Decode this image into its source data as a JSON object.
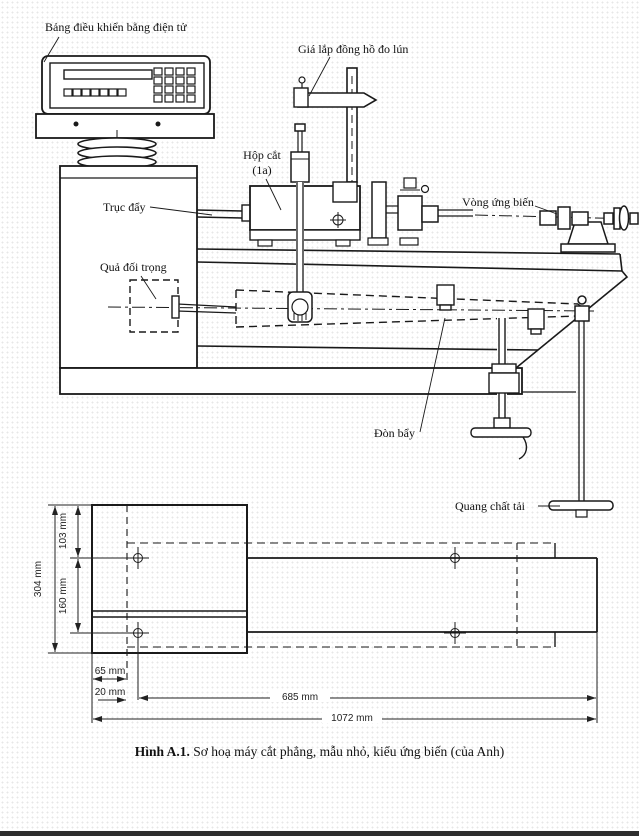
{
  "figure": {
    "caption_label": "Hình A.1.",
    "caption_text": "Sơ hoạ máy cắt phẳng, mẫu nhỏ, kiểu ứng biến (của Anh)"
  },
  "labels": {
    "control_panel": "Bảng điều khiển bằng điện tử",
    "dial_gauge_bracket": "Giá lắp đồng hồ đo lún",
    "shear_box_line1": "Hộp cắt",
    "shear_box_line2": "(1a)",
    "push_shaft": "Trục đẩy",
    "strain_ring": "Vòng ứng biến",
    "counterweight": "Quả đối trọng",
    "lever": "Đòn bẩy",
    "load_hanger": "Quang chất tải"
  },
  "dimensions": {
    "d103": "103 mm",
    "d304": "304 mm",
    "d160": "160 mm",
    "d65": "65 mm",
    "d20": "20 mm",
    "d685": "685 mm",
    "d1072": "1072 mm"
  },
  "colors": {
    "ink": "#1a1a1a",
    "paper": "#ffffff"
  }
}
